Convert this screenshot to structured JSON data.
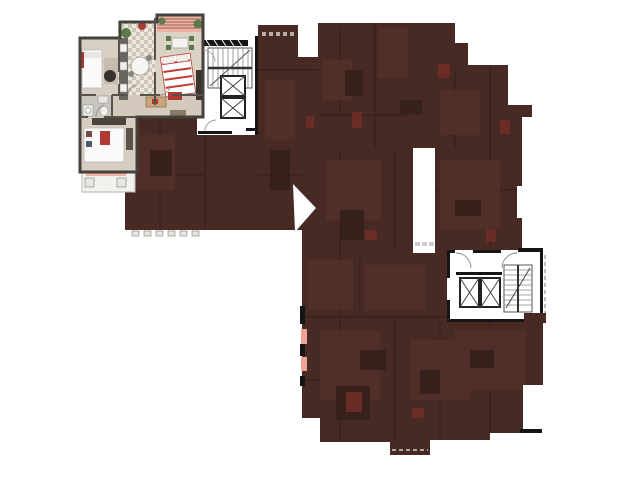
{
  "app": {
    "description": "interactive-building-floorplan-unit-selector",
    "background": "#ffffff"
  },
  "palette": {
    "dim_overlay": "#482a25",
    "dim_room_light": "#52302a",
    "dim_furniture_dark": "#35201b",
    "dim_accent_red": "#6e2d26",
    "balcony_door_marker": "#f0a294",
    "unit_floor": "#dbd2c6",
    "unit_floor_alt": "#d7cfc4",
    "unit_wall": "#45413c",
    "unit_inner_wall": "#56524c",
    "balcony_salmon": "#eeb2a4",
    "accent_red": "#b03a33",
    "accent_green": "#5d7a4b",
    "wood": "#c9a57e",
    "core_wall": "#151515",
    "core_line": "#666666",
    "white": "#ffffff",
    "tile_dark": "#cdc5b8",
    "railing_gray": "#bbbbbb"
  },
  "floorplan": {
    "highlighted_unit": {
      "id": "unit-northwest-corner",
      "state": "highlighted",
      "rooms": [
        "bedroom",
        "kitchen",
        "living-room",
        "bathroom",
        "hallway",
        "second-bedroom",
        "loggia",
        "balcony"
      ],
      "furniture_accents": [
        "red-white-striped-bed",
        "green-dining-chairs",
        "round-kitchen-table",
        "plant",
        "washing-machine",
        "red-pillows"
      ]
    },
    "dimmed_units": {
      "state": "dimmed",
      "overlay_color": "#482a25",
      "balcony_door_markers": 2
    },
    "cores": [
      {
        "id": "stair-elevator-core-west",
        "elevator_shafts": 2,
        "staircases": 1
      },
      {
        "id": "stair-elevator-core-east",
        "elevator_shafts": 2,
        "staircases": 1
      }
    ]
  }
}
